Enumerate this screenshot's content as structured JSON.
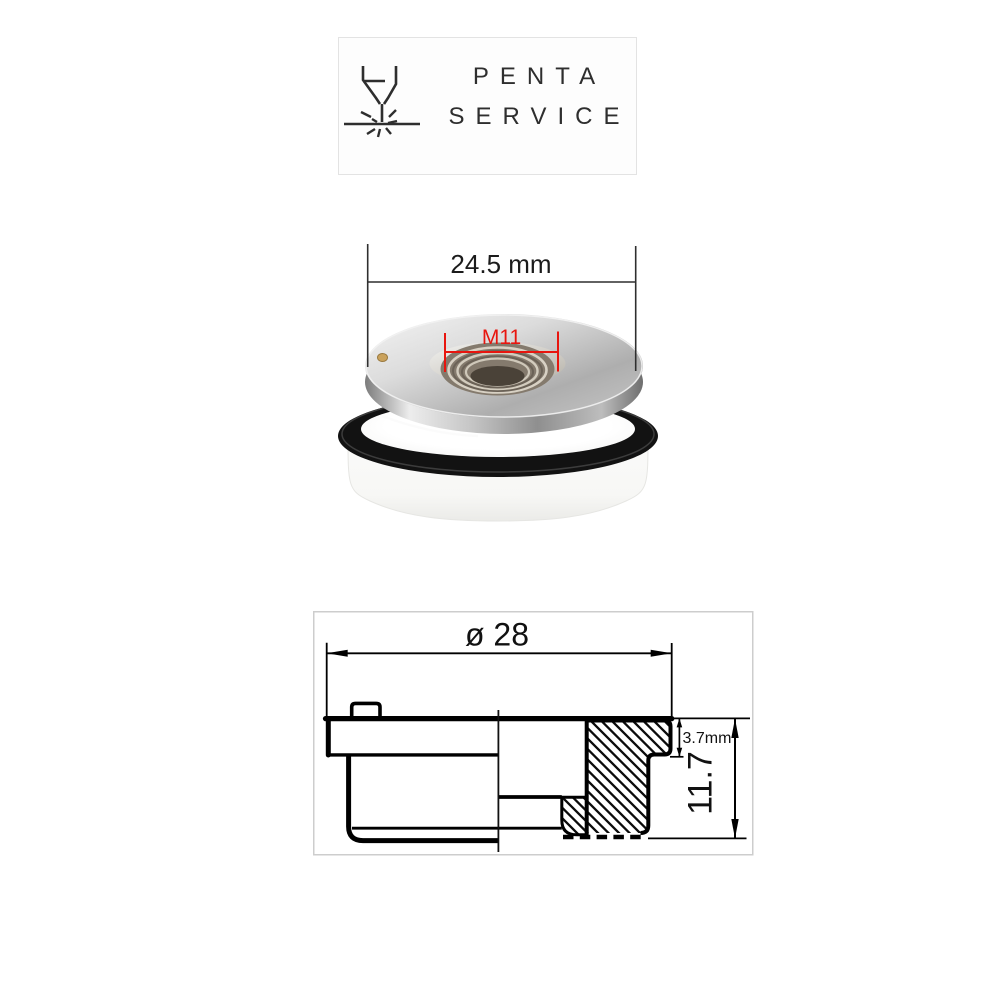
{
  "logo": {
    "icon": "laser-cutting-head-icon",
    "line1": "PENTA",
    "line2": "SERVICE"
  },
  "photo": {
    "outer_width_label": "24.5 mm",
    "thread_label": "M11",
    "annotation_color": "#e8150e",
    "dimension_line_color": "#2f2f2f"
  },
  "drawing": {
    "diameter_label": "ø 28",
    "step_height_label": "3.7mm",
    "total_height_label": "11.7",
    "line_color": "#000000",
    "frame_color": "#cdcdcd"
  }
}
